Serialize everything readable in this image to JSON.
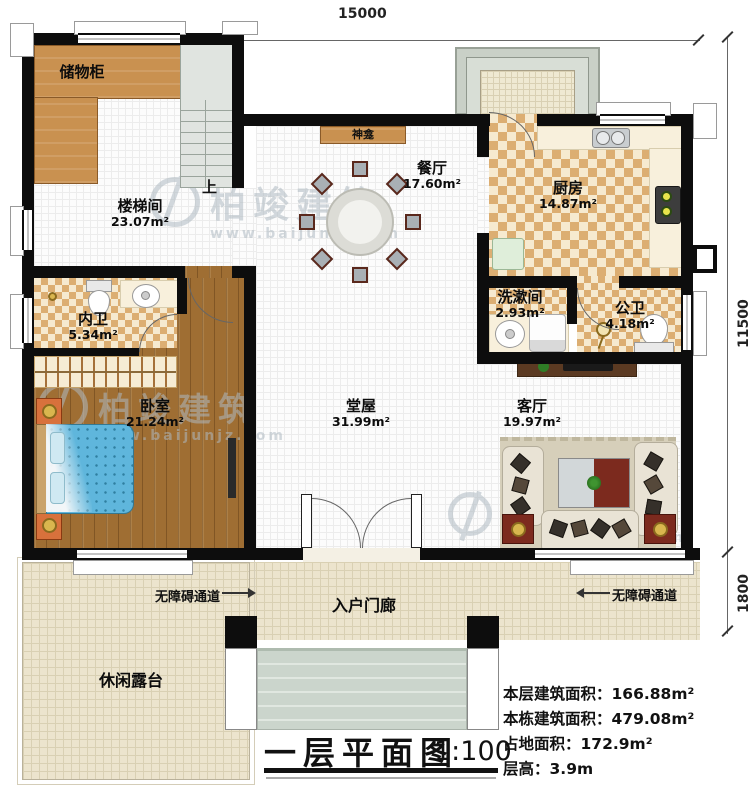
{
  "dims": {
    "top": "15000",
    "right_upper": "11500",
    "right_lower": "1800"
  },
  "rooms": [
    {
      "name": "储物柜",
      "area": ""
    },
    {
      "name": "楼梯间",
      "area": "23.07m²"
    },
    {
      "name": "餐厅",
      "area": "17.60m²"
    },
    {
      "name": "厨房",
      "area": "14.87m²"
    },
    {
      "name": "内卫",
      "area": "5.34m²"
    },
    {
      "name": "洗漱间",
      "area": "2.93m²"
    },
    {
      "name": "公卫",
      "area": "4.18m²"
    },
    {
      "name": "卧室",
      "area": "21.24m²"
    },
    {
      "name": "堂屋",
      "area": "31.99m²"
    },
    {
      "name": "客厅",
      "area": "19.97m²"
    },
    {
      "name": "入户门廊",
      "area": ""
    },
    {
      "name": "休闲露台",
      "area": ""
    }
  ],
  "annotations": {
    "shrine": "神龛",
    "stairs_up": "上",
    "accessible": "无障碍通道"
  },
  "titleblock": {
    "title": "一层平面图",
    "scale": "1:100"
  },
  "stats": [
    {
      "label": "本层建筑面积：",
      "value": "166.88m²"
    },
    {
      "label": "本栋建筑面积：",
      "value": "479.08m²"
    },
    {
      "label": "占地面积：",
      "value": "172.9m²"
    },
    {
      "label": "层高：",
      "value": "3.9m"
    }
  ],
  "watermark": {
    "brand": "柏竣建筑",
    "url": "www.baijunjz.com"
  },
  "colors": {
    "wall": "#0d0d0d",
    "checker": "#dcae72",
    "wood_cabinet": "#c99150",
    "wood_floor": "#9f6e33",
    "bed": "#5fb6dc",
    "accent_red": "#7c2a1e",
    "paving": "#ece4cd",
    "porch_steps": "#cbd5cc"
  }
}
